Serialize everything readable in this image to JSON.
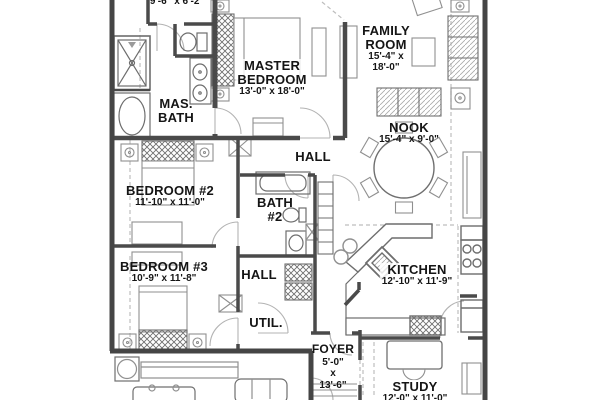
{
  "plan_type": "floor-plan",
  "colors": {
    "background": "#ffffff",
    "wall": "#4a4a4a",
    "furniture_line": "#8f8f8f",
    "fixture_line": "#6d6d6d",
    "dashed_line": "#bdbdbd",
    "text": "#151515"
  },
  "rooms": {
    "closet": {
      "dim": "9'-6\" x 6'-2\""
    },
    "master_bedroom": {
      "name1": "MASTER",
      "name2": "BEDROOM",
      "dim": "13'-0\" x 18'-0\""
    },
    "master_bath": {
      "name1": "MAS.",
      "name2": "BATH"
    },
    "family_room": {
      "name1": "FAMILY",
      "name2": "ROOM",
      "dim1": "15'-4\" x",
      "dim2": "18'-0\""
    },
    "nook": {
      "name": "NOOK",
      "dim": "15'-4\" x 9'-0\""
    },
    "bedroom2": {
      "name": "BEDROOM #2",
      "dim": "11'-10\" x 11'-0\""
    },
    "hall_upper": {
      "name": "HALL"
    },
    "bath2": {
      "name1": "BATH",
      "name2": "#2"
    },
    "bedroom3": {
      "name": "BEDROOM #3",
      "dim": "10'-9\" x 11'-8\""
    },
    "hall_lower": {
      "name": "HALL"
    },
    "utility": {
      "name": "UTIL."
    },
    "kitchen": {
      "name": "KITCHEN",
      "dim": "12'-10\" x 11'-9\""
    },
    "foyer": {
      "name": "FOYER",
      "dim1": "5'-0\"",
      "dim2": "x",
      "dim3": "13'-6\""
    },
    "study": {
      "name": "STUDY",
      "dim": "12'-0\" x 11'-0\""
    }
  }
}
